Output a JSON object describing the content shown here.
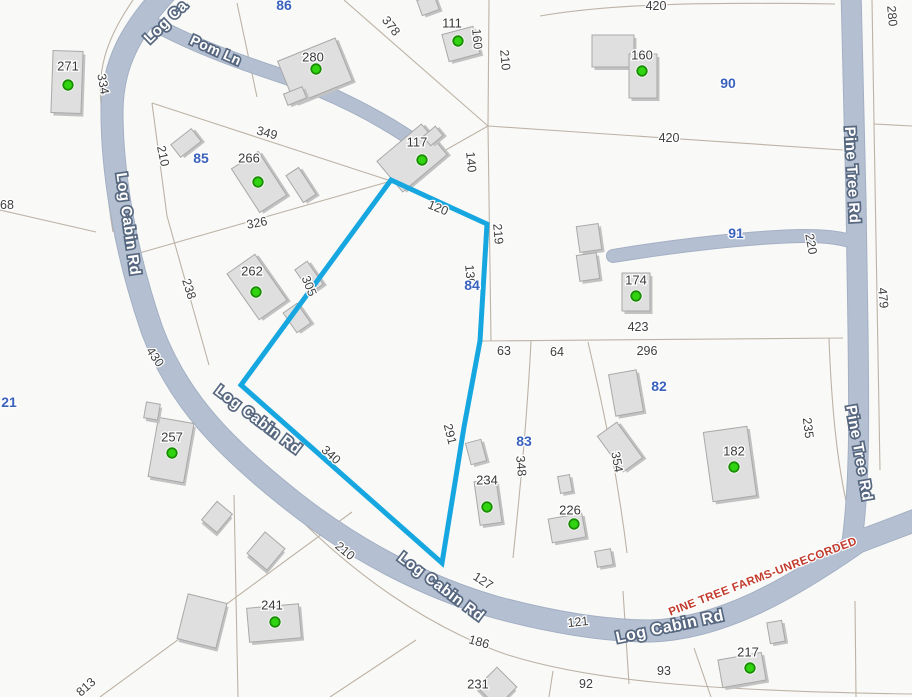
{
  "canvas": {
    "width": 912,
    "height": 697,
    "background": "#f9f9f7"
  },
  "colors": {
    "road_fill": "#b4c0d2",
    "road_casing": "#a3afc3",
    "highlight": "#17a7e0",
    "parcel_line": "#bdb3a6",
    "building_fill": "#dfdfdf",
    "building_stroke": "#a9a9a9",
    "building_shadow": "#c2c2c2",
    "dwelling_dot": "#31d411",
    "dwelling_dot_ring": "#1d8d07",
    "dimension_text": "#3f3f3f",
    "lot_number_text": "#3a62bd",
    "plat_text": "#c23b2d"
  },
  "roads": [
    {
      "name": "log-cabin-rd",
      "d": "M 170,-12 C 130,30 112,65 112,112 C 112,175 126,255 152,330 C 178,400 225,448 295,503 C 355,550 425,587 495,607 C 550,622 605,631 650,631 C 722,629 792,588 858,542 L 916,520",
      "w": 21,
      "cap": "butt"
    },
    {
      "name": "pine-tree-rd",
      "d": "M 851,-10 L 856,200 L 858,330 C 859,420 860,480 852,542",
      "w": 19,
      "cap": "butt"
    },
    {
      "name": "pom-ln",
      "d": "M 158,26 C 200,48 240,62 282,76 C 332,92 382,118 426,149",
      "w": 13,
      "cap": "round"
    },
    {
      "name": "driveway-91",
      "d": "M 613,256 C 680,245 752,237 802,236 C 822,236 836,237 850,241",
      "w": 12,
      "cap": "round"
    }
  ],
  "road_labels": [
    {
      "text": "Log Ca",
      "x": 166,
      "y": 22,
      "rot": -44,
      "size": 15
    },
    {
      "text": "Pom Ln",
      "x": 216,
      "y": 50,
      "rot": 24,
      "size": 14
    },
    {
      "text": "Log Cabin Rd",
      "x": 128,
      "y": 224,
      "rot": 82,
      "size": 15
    },
    {
      "text": "Log Cabin Rd",
      "x": 258,
      "y": 420,
      "rot": 37,
      "size": 15
    },
    {
      "text": "Log Cabin Rd",
      "x": 441,
      "y": 587,
      "rot": 37,
      "size": 15
    },
    {
      "text": "Log Cabin Rd",
      "x": 670,
      "y": 627,
      "rot": -12,
      "size": 16
    },
    {
      "text": "Pine Tree Rd",
      "x": 852,
      "y": 175,
      "rot": 87,
      "size": 15
    },
    {
      "text": "Pine Tree Rd",
      "x": 859,
      "y": 453,
      "rot": 80,
      "size": 15
    }
  ],
  "highlight_parcel": {
    "lot": "84",
    "points": "391,180 487,224 480,341 464,427 442,563 241,385",
    "stroke_width": 5
  },
  "parcel_lines": [
    "M 133,0 C 104,42 98,72 101,104 C 104,162 107,196 113,232",
    "M 0,210 L 96,232",
    "M 152,103 L 167,216 L 209,365",
    "M 152,103 L 391,181",
    "M 136,254 L 391,181",
    "M 344,0 L 488,126",
    "M 489,0 L 488,126",
    "M 488,126 L 391,181",
    "M 488,126 L 491,341",
    "M 488,126 L 843,150",
    "M 540,16 C 610,4 700,2 835,4",
    "M 872,0 L 874,124 L 912,126",
    "M 874,124 L 880,470",
    "M 480,341 L 843,338",
    "M 531,341 C 527,420 521,480 513,558",
    "M 588,342 C 606,420 618,480 627,553",
    "M 829,338 C 832,420 839,475 850,518",
    "M 272,490 C 350,576 432,628 505,654 C 585,680 700,691 912,694",
    "M 100,697 L 352,512",
    "M 234,495 L 238,697",
    "M 416,640 L 330,697",
    "M 553,671 L 549,697",
    "M 623,591 L 629,684",
    "M 694,648 L 711,697",
    "M 855,601 L 856,697",
    "M 237,3 L 257,97"
  ],
  "dimension_labels": [
    {
      "t": "334",
      "x": 103,
      "y": 84,
      "r": 80
    },
    {
      "t": "68",
      "x": 7,
      "y": 205,
      "r": 0
    },
    {
      "t": "378",
      "x": 391,
      "y": 26,
      "r": 52
    },
    {
      "t": "349",
      "x": 267,
      "y": 133,
      "r": 15
    },
    {
      "t": "210",
      "x": 163,
      "y": 156,
      "r": 78
    },
    {
      "t": "326",
      "x": 257,
      "y": 223,
      "r": -11
    },
    {
      "t": "238",
      "x": 189,
      "y": 289,
      "r": 72
    },
    {
      "t": "430",
      "x": 155,
      "y": 357,
      "r": 55
    },
    {
      "t": "305",
      "x": 309,
      "y": 286,
      "r": 68
    },
    {
      "t": "160",
      "x": 477,
      "y": 39,
      "r": 85
    },
    {
      "t": "210",
      "x": 505,
      "y": 60,
      "r": 85
    },
    {
      "t": "420",
      "x": 656,
      "y": 6,
      "r": 0
    },
    {
      "t": "280",
      "x": 892,
      "y": 16,
      "r": 85
    },
    {
      "t": "140",
      "x": 471,
      "y": 162,
      "r": 85
    },
    {
      "t": "420",
      "x": 669,
      "y": 138,
      "r": 0
    },
    {
      "t": "120",
      "x": 438,
      "y": 208,
      "r": 22
    },
    {
      "t": "219",
      "x": 498,
      "y": 234,
      "r": 85
    },
    {
      "t": "130",
      "x": 470,
      "y": 275,
      "r": 85
    },
    {
      "t": "220",
      "x": 811,
      "y": 244,
      "r": 80
    },
    {
      "t": "479",
      "x": 883,
      "y": 298,
      "r": 85
    },
    {
      "t": "423",
      "x": 638,
      "y": 327,
      "r": 0
    },
    {
      "t": "63",
      "x": 504,
      "y": 351,
      "r": 0
    },
    {
      "t": "64",
      "x": 557,
      "y": 352,
      "r": 0
    },
    {
      "t": "296",
      "x": 647,
      "y": 351,
      "r": 0
    },
    {
      "t": "235",
      "x": 808,
      "y": 428,
      "r": 83
    },
    {
      "t": "354",
      "x": 617,
      "y": 462,
      "r": 80
    },
    {
      "t": "348",
      "x": 521,
      "y": 466,
      "r": 85
    },
    {
      "t": "291",
      "x": 450,
      "y": 434,
      "r": 76
    },
    {
      "t": "340",
      "x": 331,
      "y": 455,
      "r": 42
    },
    {
      "t": "210",
      "x": 345,
      "y": 551,
      "r": 40
    },
    {
      "t": "127",
      "x": 483,
      "y": 581,
      "r": 33
    },
    {
      "t": "186",
      "x": 479,
      "y": 642,
      "r": 16
    },
    {
      "t": "121",
      "x": 578,
      "y": 622,
      "r": -6
    },
    {
      "t": "92",
      "x": 586,
      "y": 684,
      "r": 0
    },
    {
      "t": "93",
      "x": 664,
      "y": 671,
      "r": 0
    },
    {
      "t": "813",
      "x": 86,
      "y": 687,
      "r": -42
    }
  ],
  "lot_numbers": [
    {
      "t": "86",
      "x": 284,
      "y": 5
    },
    {
      "t": "90",
      "x": 728,
      "y": 83
    },
    {
      "t": "85",
      "x": 201,
      "y": 158
    },
    {
      "t": "84",
      "x": 472,
      "y": 285
    },
    {
      "t": "91",
      "x": 736,
      "y": 233
    },
    {
      "t": "82",
      "x": 659,
      "y": 386
    },
    {
      "t": "83",
      "x": 524,
      "y": 441
    },
    {
      "t": "21",
      "x": 9,
      "y": 402
    }
  ],
  "house_numbers": [
    {
      "t": "271",
      "x": 68,
      "y": 66
    },
    {
      "t": "266",
      "x": 249,
      "y": 158
    },
    {
      "t": "280",
      "x": 313,
      "y": 57
    },
    {
      "t": "111",
      "x": 452,
      "y": 23
    },
    {
      "t": "117",
      "x": 417,
      "y": 142
    },
    {
      "t": "160",
      "x": 642,
      "y": 55
    },
    {
      "t": "174",
      "x": 636,
      "y": 280
    },
    {
      "t": "262",
      "x": 252,
      "y": 271
    },
    {
      "t": "257",
      "x": 172,
      "y": 437
    },
    {
      "t": "234",
      "x": 487,
      "y": 480
    },
    {
      "t": "226",
      "x": 570,
      "y": 510
    },
    {
      "t": "241",
      "x": 272,
      "y": 605
    },
    {
      "t": "182",
      "x": 734,
      "y": 451
    },
    {
      "t": "217",
      "x": 748,
      "y": 652
    },
    {
      "t": "231",
      "x": 478,
      "y": 684
    }
  ],
  "buildings": [
    {
      "cx": 67,
      "cy": 82,
      "w": 30,
      "h": 62,
      "rot": 2
    },
    {
      "cx": 186,
      "cy": 143,
      "w": 26,
      "h": 16,
      "rot": -38
    },
    {
      "cx": 259,
      "cy": 182,
      "w": 32,
      "h": 52,
      "rot": -33
    },
    {
      "cx": 301,
      "cy": 185,
      "w": 15,
      "h": 32,
      "rot": -33
    },
    {
      "cx": 315,
      "cy": 71,
      "w": 62,
      "h": 46,
      "rot": -22
    },
    {
      "cx": 295,
      "cy": 96,
      "w": 20,
      "h": 12,
      "rot": -22
    },
    {
      "cx": 461,
      "cy": 44,
      "w": 32,
      "h": 28,
      "rot": -15
    },
    {
      "cx": 428,
      "cy": 5,
      "w": 18,
      "h": 16,
      "rot": -20
    },
    {
      "cx": 412,
      "cy": 158,
      "w": 58,
      "h": 40,
      "rot": -40
    },
    {
      "cx": 433,
      "cy": 136,
      "w": 16,
      "h": 12,
      "rot": -40
    },
    {
      "cx": 613,
      "cy": 51,
      "w": 42,
      "h": 32,
      "rot": 0
    },
    {
      "cx": 643,
      "cy": 76,
      "w": 28,
      "h": 44,
      "rot": 0
    },
    {
      "cx": 636,
      "cy": 292,
      "w": 28,
      "h": 38,
      "rot": 0
    },
    {
      "cx": 589,
      "cy": 238,
      "w": 22,
      "h": 26,
      "rot": -8
    },
    {
      "cx": 588,
      "cy": 267,
      "w": 20,
      "h": 26,
      "rot": -8
    },
    {
      "cx": 626,
      "cy": 393,
      "w": 28,
      "h": 42,
      "rot": -10
    },
    {
      "cx": 620,
      "cy": 447,
      "w": 24,
      "h": 44,
      "rot": -36
    },
    {
      "cx": 730,
      "cy": 464,
      "w": 44,
      "h": 70,
      "rot": -8
    },
    {
      "cx": 488,
      "cy": 502,
      "w": 22,
      "h": 44,
      "rot": -8
    },
    {
      "cx": 476,
      "cy": 452,
      "w": 16,
      "h": 22,
      "rot": -15
    },
    {
      "cx": 567,
      "cy": 528,
      "w": 34,
      "h": 24,
      "rot": -10
    },
    {
      "cx": 565,
      "cy": 484,
      "w": 12,
      "h": 17,
      "rot": -10
    },
    {
      "cx": 604,
      "cy": 558,
      "w": 16,
      "h": 16,
      "rot": -10
    },
    {
      "cx": 171,
      "cy": 450,
      "w": 36,
      "h": 60,
      "rot": 10
    },
    {
      "cx": 152,
      "cy": 411,
      "w": 14,
      "h": 16,
      "rot": 10
    },
    {
      "cx": 217,
      "cy": 517,
      "w": 20,
      "h": 24,
      "rot": 40
    },
    {
      "cx": 266,
      "cy": 551,
      "w": 26,
      "h": 28,
      "rot": 40
    },
    {
      "cx": 202,
      "cy": 621,
      "w": 40,
      "h": 46,
      "rot": 14
    },
    {
      "cx": 274,
      "cy": 623,
      "w": 52,
      "h": 34,
      "rot": -5
    },
    {
      "cx": 497,
      "cy": 687,
      "w": 28,
      "h": 28,
      "rot": 45
    },
    {
      "cx": 742,
      "cy": 670,
      "w": 44,
      "h": 28,
      "rot": -10
    },
    {
      "cx": 776,
      "cy": 632,
      "w": 15,
      "h": 21,
      "rot": -10
    },
    {
      "cx": 257,
      "cy": 287,
      "w": 34,
      "h": 56,
      "rot": -35
    },
    {
      "cx": 309,
      "cy": 277,
      "w": 15,
      "h": 28,
      "rot": -35
    },
    {
      "cx": 297,
      "cy": 318,
      "w": 17,
      "h": 24,
      "rot": -35
    }
  ],
  "dwelling_dots": [
    {
      "x": 68,
      "y": 85
    },
    {
      "x": 258,
      "y": 182
    },
    {
      "x": 316,
      "y": 69
    },
    {
      "x": 458,
      "y": 41
    },
    {
      "x": 422,
      "y": 160
    },
    {
      "x": 642,
      "y": 71
    },
    {
      "x": 636,
      "y": 296
    },
    {
      "x": 256,
      "y": 292
    },
    {
      "x": 172,
      "y": 453
    },
    {
      "x": 487,
      "y": 507
    },
    {
      "x": 574,
      "y": 524
    },
    {
      "x": 275,
      "y": 622
    },
    {
      "x": 734,
      "y": 467
    },
    {
      "x": 750,
      "y": 668
    }
  ],
  "plat_note": {
    "text": "PINE TREE FARMS-UNRECORDED",
    "x": 763,
    "y": 577,
    "rot": -21
  }
}
